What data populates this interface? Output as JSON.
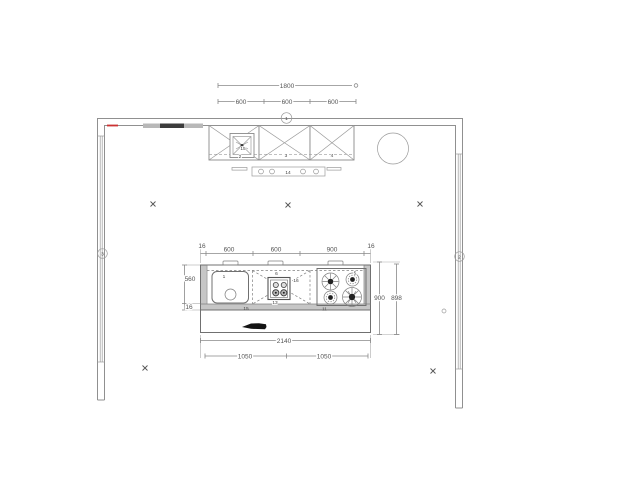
{
  "labels": {
    "dim_overall_top": "1800",
    "dim_top_seg1": "600",
    "dim_top_seg2": "600",
    "dim_top_seg3": "600",
    "marker_top_wall": "1",
    "marker_left_wall": "3",
    "marker_right_wall": "2",
    "cabinet_1": "2",
    "cabinet_2": "3",
    "cabinet_3": "4",
    "vent_item": "15",
    "hood_item": "14",
    "island_dim_edge_left": "16",
    "island_dim_seg1": "600",
    "island_dim_seg2": "600",
    "island_dim_seg3": "900",
    "island_dim_edge_right": "16",
    "island_depth": "560",
    "island_edge_thickness": "16",
    "island_right_dim1": "900",
    "island_right_dim2": "898",
    "island_total_width": "2140",
    "island_bottom_seg1": "1050",
    "island_bottom_seg2": "1050",
    "sink_item": "1",
    "mid_unit_item": "6",
    "mid_unit_right_item": "16",
    "mid_unit_bottom_item": "13",
    "cooktop_item": "5",
    "worktop_left_item": "15",
    "worktop_right_item": "11"
  },
  "colors": {
    "line": "#8a8a8a",
    "dim_text": "#555555",
    "accent_marker": "#cc3333",
    "dark_fill": "#1a1a1a",
    "counter_edge": "#c6c6c6"
  }
}
